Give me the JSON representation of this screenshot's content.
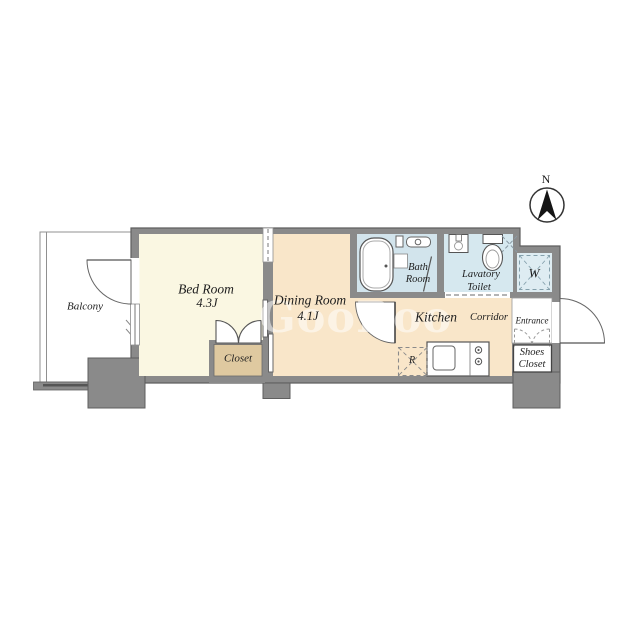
{
  "compass": {
    "label": "N"
  },
  "watermark": {
    "text": "GooRoo"
  },
  "rooms": {
    "balcony": {
      "name": "Balcony"
    },
    "bed_room": {
      "name": "Bed Room",
      "size": "4.3J"
    },
    "dining_room": {
      "name": "Dining Room",
      "size": "4.1J"
    },
    "closet": {
      "name": "Closet"
    },
    "bath_room": {
      "name_line1": "Bath",
      "name_line2": "Room"
    },
    "lavatory_toilet": {
      "name_line1": "Lavatory",
      "name_line2": "Toilet"
    },
    "washer_space": {
      "name": "W"
    },
    "kitchen": {
      "name": "Kitchen"
    },
    "corridor": {
      "name": "Corridor"
    },
    "entrance": {
      "name": "Entrance"
    },
    "shoes_closet": {
      "name_line1": "Shoes",
      "name_line2": "Closet"
    },
    "refrigerator_space": {
      "name": "R"
    }
  },
  "colors": {
    "wall": "#8A8A8A",
    "wall_outline": "#5F5F5F",
    "bedroom_floor": "#FAF7E2",
    "dining_kitchen_floor": "#F9E6C9",
    "closet_floor": "#DFC9A0",
    "bath_floor": "#D2E4EC",
    "lavatory_floor": "#D6E8EF",
    "washer_floor": "#DEECF2",
    "balcony_floor": "#FFFFFF",
    "label_text": "#1E1E1E"
  }
}
